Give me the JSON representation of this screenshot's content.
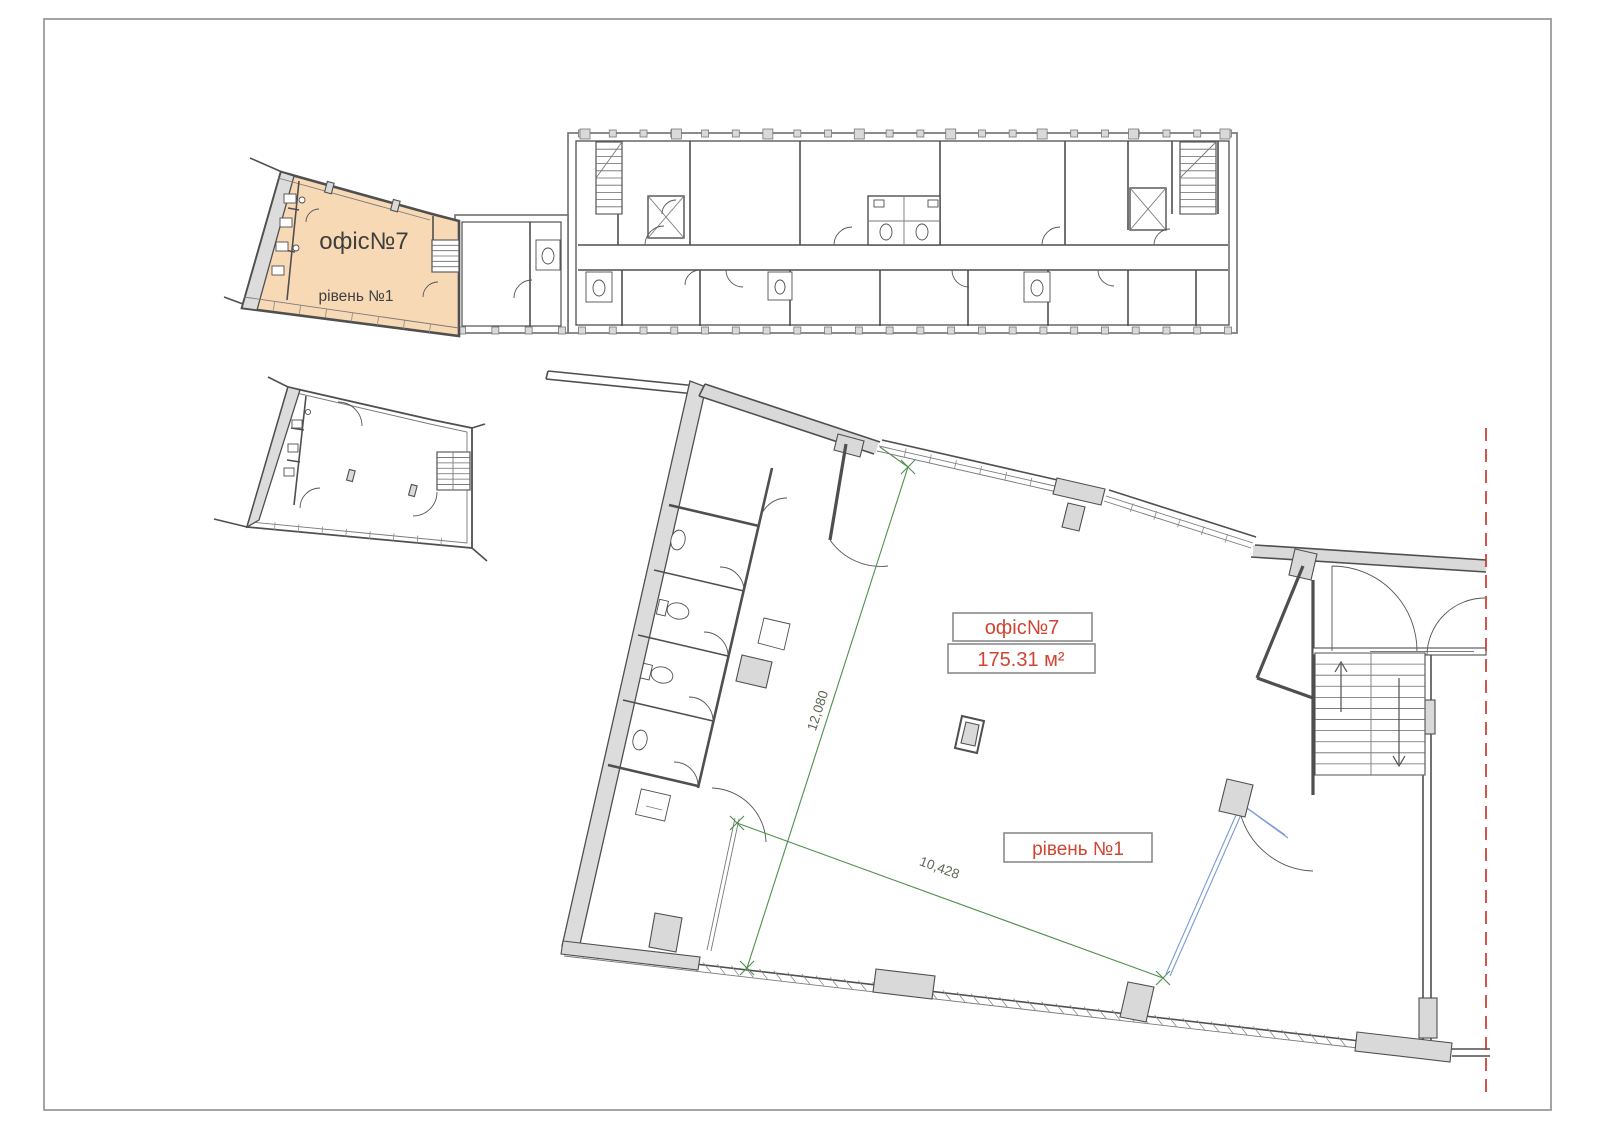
{
  "page": {
    "background": "#ffffff",
    "border_color": "#9b9b9b"
  },
  "colors": {
    "highlight_fill": "#f8d9b5",
    "wall_fill": "#d9d9d9",
    "wall_line": "#4f4f4f",
    "plan_text": "#3f3f3f",
    "label_red": "#cf4531",
    "label_box_border": "#8a8a8a",
    "dimension_green": "#4e8f4e",
    "dimension_text": "#5a6a55",
    "marker_blue": "#7a9bd4",
    "cut_line_red": "#c8372d"
  },
  "overview_plan": {
    "office_label": "офіс№7",
    "level_label": "рівень №1"
  },
  "detail_plan": {
    "office_label": "офіс№7",
    "area_label": "175.31 м²",
    "level_label": "рівень №1",
    "dimension_long": "12,080",
    "dimension_short": "10,428"
  }
}
